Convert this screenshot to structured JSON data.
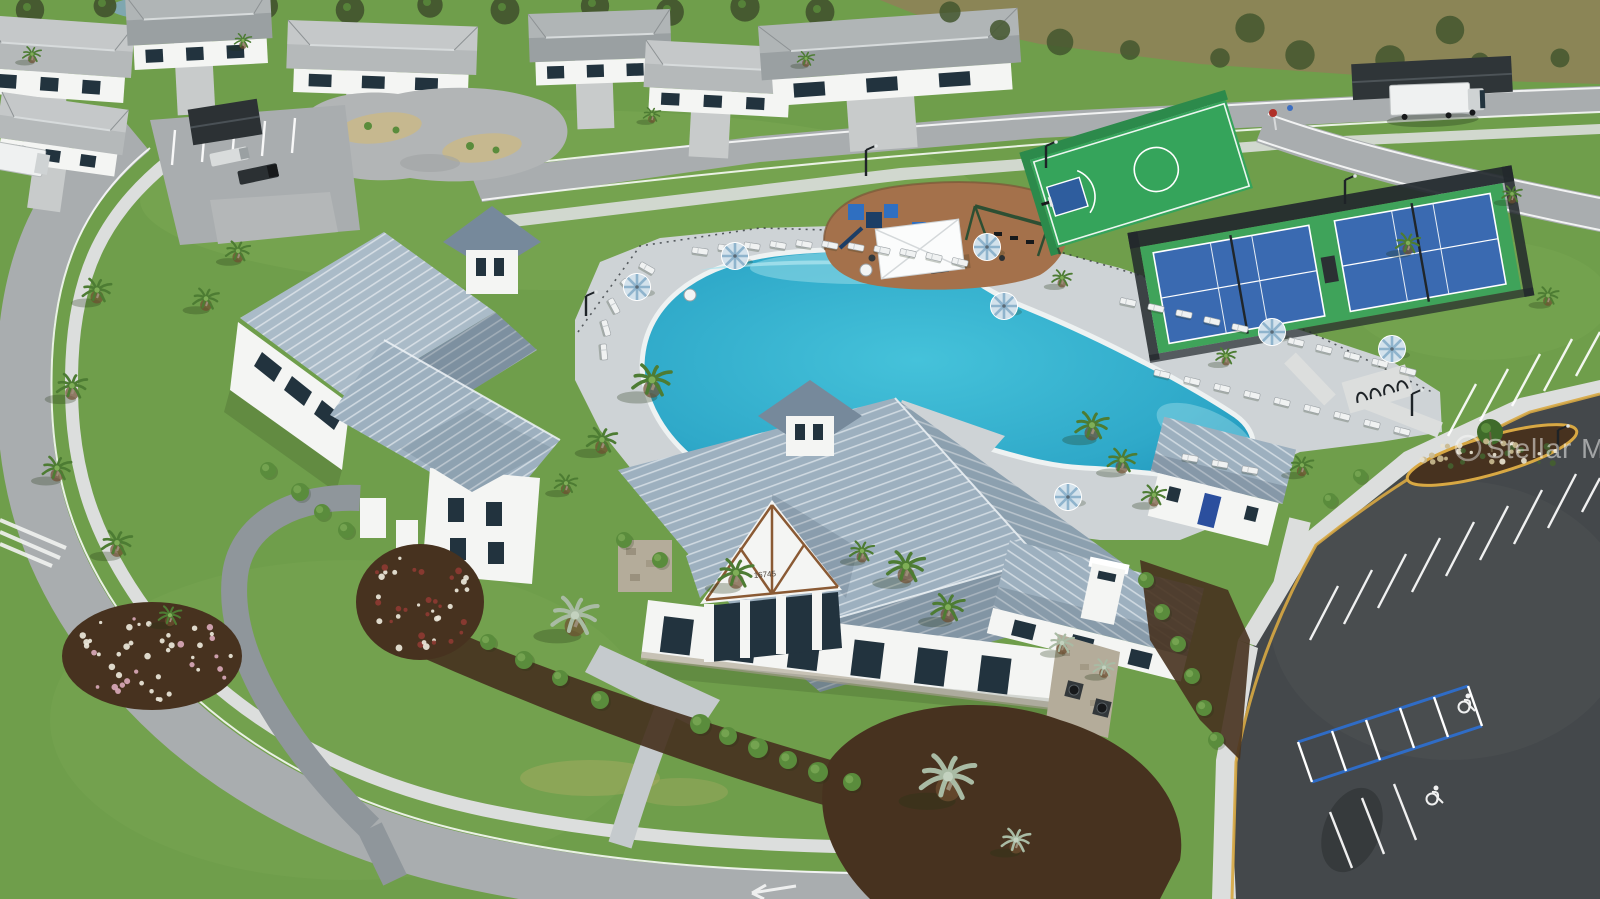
{
  "image": {
    "type": "aerial-drone-photograph",
    "subject": "Resort-style community amenity center: clubhouse with standing-seam metal roofs, lagoon pool with loungers and umbrellas, pickleball and basketball courts, playground, pump track, parking lots, palm landscaping and surrounding single-family homes",
    "width": 1600,
    "height": 899
  },
  "watermark": {
    "logo": "mls-circle-logo",
    "text": "Stellar MLS"
  },
  "clubhouse": {
    "address_number": "16745"
  },
  "colors": {
    "grassBase": "#6f9e4b",
    "grassLight": "#86b35d",
    "grassDark": "#567f39",
    "grassPale": "#b9b06a",
    "preserve": "#8b8556",
    "preserveTree": "#43562e",
    "pond": "#7fa7b0",
    "road": "#a9adaf",
    "roadLight": "#c2c5c6",
    "sidewalk": "#dcdedd",
    "paver": "#c5cacd",
    "paverDark": "#8f969b",
    "asphalt": "#44484b",
    "asphaltLight": "#5a5e61",
    "pool": "#3bb8d6",
    "poolDeep": "#1f96bc",
    "poolShallow": "#aae4ee",
    "coping": "#eef2f2",
    "deck": "#ced3d6",
    "roof": "#9db0bf",
    "roofDark": "#76899b",
    "roofBright": "#c2cfda",
    "seam": "#eef3f7",
    "wall": "#f4f5f3",
    "wallShade": "#d8dbda",
    "stone": "#b4ac9a",
    "mulch": "#47321f",
    "mulchLight": "#6f4f30",
    "playMulch": "#a4714b",
    "shrub": "#5a8c3c",
    "shrubDark": "#3f6b2a",
    "palmGreen": "#4d7c33",
    "palmSilver": "#a9bba4",
    "trunk": "#9b8d77",
    "courtBlue": "#3a6ab1",
    "courtGreen": "#3fa35a",
    "bballGreen": "#35a45b",
    "keyBlue": "#2e5d9e",
    "fence": "#22282c",
    "umbrella": "#d3e2ec",
    "umbrellaStripe": "#8fb4cd",
    "flowerWhite": "#ece7da",
    "flowerRed": "#8d3a32",
    "yellow": "#d8a843",
    "hcBlue": "#2f6cc6",
    "doorBlue": "#2b4f9e",
    "glass": "#22333e",
    "carDark": "#2b3033",
    "truckWhite": "#eff1f1"
  },
  "scatter": {
    "palms": [
      [
        97,
        296,
        1.0,
        "g"
      ],
      [
        72,
        392,
        1.05,
        "g"
      ],
      [
        57,
        474,
        1.0,
        "g"
      ],
      [
        117,
        549,
        1.05,
        "g"
      ],
      [
        206,
        304,
        0.9,
        "g"
      ],
      [
        238,
        256,
        0.85,
        "g"
      ],
      [
        170,
        620,
        0.8,
        "g"
      ],
      [
        652,
        388,
        1.35,
        "g"
      ],
      [
        602,
        446,
        1.05,
        "g"
      ],
      [
        566,
        488,
        0.8,
        "g"
      ],
      [
        736,
        580,
        1.2,
        "g"
      ],
      [
        906,
        574,
        1.3,
        "g"
      ],
      [
        948,
        614,
        1.15,
        "g"
      ],
      [
        862,
        556,
        0.85,
        "g"
      ],
      [
        1092,
        432,
        1.15,
        "g"
      ],
      [
        1122,
        466,
        1.0,
        "g"
      ],
      [
        1154,
        500,
        0.85,
        "g"
      ],
      [
        1226,
        360,
        0.7,
        "g"
      ],
      [
        1302,
        470,
        0.8,
        "g"
      ],
      [
        575,
        625,
        1.6,
        "s"
      ],
      [
        948,
        788,
        1.9,
        "s"
      ],
      [
        1016,
        846,
        1.0,
        "s"
      ],
      [
        1062,
        648,
        0.85,
        "s"
      ],
      [
        1104,
        672,
        0.75,
        "s"
      ],
      [
        32,
        58,
        0.65,
        "g"
      ],
      [
        243,
        44,
        0.6,
        "g"
      ],
      [
        652,
        118,
        0.6,
        "g"
      ],
      [
        806,
        62,
        0.6,
        "g"
      ],
      [
        1408,
        248,
        0.85,
        "g"
      ],
      [
        1512,
        198,
        0.7,
        "g"
      ],
      [
        1548,
        300,
        0.75,
        "g"
      ],
      [
        1062,
        282,
        0.7,
        "g"
      ]
    ],
    "umbrellas": [
      [
        637,
        287
      ],
      [
        735,
        256
      ],
      [
        987,
        247
      ],
      [
        1004,
        306
      ],
      [
        1272,
        332
      ],
      [
        1068,
        497
      ],
      [
        1392,
        349
      ]
    ],
    "loungers": [
      [
        700,
        251,
        8
      ],
      [
        726,
        248,
        8
      ],
      [
        752,
        246,
        9
      ],
      [
        778,
        245,
        10
      ],
      [
        804,
        244,
        10
      ],
      [
        830,
        245,
        11
      ],
      [
        856,
        247,
        11
      ],
      [
        882,
        250,
        12
      ],
      [
        908,
        253,
        12
      ],
      [
        934,
        257,
        13
      ],
      [
        960,
        262,
        13
      ],
      [
        647,
        268,
        30
      ],
      [
        628,
        286,
        48
      ],
      [
        614,
        306,
        62
      ],
      [
        606,
        328,
        74
      ],
      [
        604,
        352,
        85
      ],
      [
        1128,
        302,
        12
      ],
      [
        1156,
        308,
        12
      ],
      [
        1184,
        314,
        12
      ],
      [
        1212,
        321,
        13
      ],
      [
        1240,
        328,
        13
      ],
      [
        1268,
        335,
        13
      ],
      [
        1296,
        342,
        13
      ],
      [
        1324,
        349,
        14
      ],
      [
        1352,
        356,
        14
      ],
      [
        1380,
        363,
        14
      ],
      [
        1408,
        371,
        14
      ],
      [
        1162,
        374,
        13
      ],
      [
        1192,
        381,
        13
      ],
      [
        1222,
        388,
        13
      ],
      [
        1252,
        395,
        13
      ],
      [
        1282,
        402,
        14
      ],
      [
        1312,
        409,
        14
      ],
      [
        1342,
        416,
        14
      ],
      [
        1372,
        424,
        14
      ],
      [
        1402,
        431,
        14
      ],
      [
        1190,
        458,
        10
      ],
      [
        1220,
        464,
        10
      ],
      [
        1250,
        470,
        10
      ]
    ],
    "stall_lines": [
      [
        1448,
        436,
        1476,
        384
      ],
      [
        1480,
        421,
        1508,
        369
      ],
      [
        1512,
        406,
        1540,
        354
      ],
      [
        1544,
        391,
        1572,
        339
      ],
      [
        1576,
        376,
        1600,
        332
      ],
      [
        1310,
        640,
        1338,
        586
      ],
      [
        1344,
        624,
        1372,
        570
      ],
      [
        1378,
        608,
        1406,
        554
      ],
      [
        1412,
        592,
        1440,
        538
      ],
      [
        1446,
        576,
        1474,
        522
      ],
      [
        1480,
        560,
        1508,
        506
      ],
      [
        1514,
        544,
        1542,
        490
      ],
      [
        1548,
        528,
        1576,
        474
      ],
      [
        1582,
        512,
        1600,
        478
      ],
      [
        1330,
        812,
        1352,
        868
      ],
      [
        1362,
        798,
        1384,
        854
      ],
      [
        1394,
        784,
        1416,
        840
      ]
    ],
    "wheelchairs": [
      [
        1464,
        704
      ],
      [
        1432,
        796
      ]
    ],
    "beds": [
      {
        "name": "white-flower-bed",
        "cx": 152,
        "cy": 656,
        "rx": 82,
        "ry": 46,
        "palette": [
          "flowerWhite",
          "flowerWhite",
          "#d9a8b8"
        ],
        "n": 46
      },
      {
        "name": "red-flower-bed",
        "cx": 420,
        "cy": 602,
        "rx": 56,
        "ry": 50,
        "palette": [
          "flowerRed",
          "flowerWhite"
        ],
        "n": 40
      },
      {
        "name": "parking-island-bed",
        "cx": 1492,
        "cy": 455,
        "rx": 80,
        "ry": 14,
        "palette": [
          "#c9ba90",
          "#e8e2cf",
          "#44602f"
        ],
        "n": 34
      }
    ],
    "shrubs": [
      [
        700,
        724,
        10
      ],
      [
        728,
        736,
        9
      ],
      [
        758,
        748,
        10
      ],
      [
        788,
        760,
        9
      ],
      [
        818,
        772,
        10
      ],
      [
        852,
        782,
        9
      ],
      [
        600,
        700,
        9
      ],
      [
        560,
        678,
        8
      ],
      [
        524,
        660,
        9
      ],
      [
        488,
        642,
        8
      ],
      [
        1146,
        580,
        8
      ],
      [
        1162,
        612,
        8
      ],
      [
        1178,
        644,
        8
      ],
      [
        1192,
        676,
        8
      ],
      [
        1204,
        708,
        8
      ],
      [
        1216,
        740,
        8
      ],
      [
        300,
        492,
        9
      ],
      [
        322,
        512,
        8
      ],
      [
        346,
        530,
        8
      ],
      [
        268,
        470,
        8
      ],
      [
        660,
        560,
        8
      ],
      [
        624,
        540,
        8
      ],
      [
        1330,
        500,
        7
      ],
      [
        1360,
        476,
        7
      ]
    ],
    "tree_row": [
      [
        30,
        10
      ],
      [
        105,
        6
      ],
      [
        185,
        12
      ],
      [
        265,
        6
      ],
      [
        350,
        10
      ],
      [
        430,
        5
      ],
      [
        505,
        10
      ],
      [
        595,
        6
      ],
      [
        670,
        12
      ],
      [
        745,
        7
      ],
      [
        820,
        12
      ]
    ],
    "preserve_trees": [
      [
        1000,
        30
      ],
      [
        1060,
        42
      ],
      [
        1130,
        50
      ],
      [
        1220,
        58
      ],
      [
        1300,
        55
      ],
      [
        1390,
        60
      ],
      [
        1480,
        62
      ],
      [
        1560,
        58
      ],
      [
        950,
        12
      ],
      [
        1250,
        28
      ],
      [
        1450,
        30
      ]
    ],
    "houses": [
      [
        -15,
        15,
        150,
        85,
        4
      ],
      [
        125,
        -5,
        145,
        82,
        -3
      ],
      [
        288,
        20,
        190,
        78,
        2
      ],
      [
        528,
        14,
        142,
        78,
        -2
      ],
      [
        646,
        40,
        152,
        76,
        3
      ],
      [
        758,
        26,
        260,
        88,
        -4
      ],
      [
        2,
        92,
        128,
        74,
        8
      ]
    ],
    "light_poles": [
      [
        866,
        150,
        26
      ],
      [
        1345,
        180,
        24
      ],
      [
        1412,
        394,
        22
      ],
      [
        1558,
        430,
        22
      ],
      [
        1046,
        146,
        22
      ],
      [
        586,
        296,
        20
      ]
    ]
  }
}
